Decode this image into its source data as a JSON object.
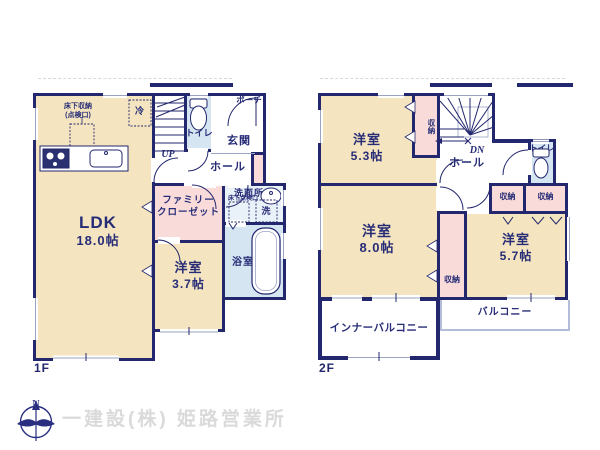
{
  "palette": {
    "wall_navy": "#23276d",
    "room_cream": "#f4e5c0",
    "closet_pink": "#f9dcda",
    "wet_area_blue": "#d5e5f2",
    "footer_gray": "#dadada"
  },
  "floor1": {
    "label": "1F",
    "ldk": {
      "name": "LDK",
      "size": "18.0帖"
    },
    "bedroom": {
      "name": "洋室",
      "size": "3.7帖"
    },
    "family_closet_line1": "ファミリー",
    "family_closet_line2": "クローゼット",
    "bath": "浴室",
    "washroom": "洗面所",
    "washer": "洗",
    "underfloor_hatch": "床下点検口",
    "toilet": "トイレ",
    "entrance": "玄関",
    "hall": "ホール",
    "porch": "ポーチ",
    "stairs_up": "UP",
    "fridge": "冷",
    "underfloor_storage_line1": "床下収納",
    "underfloor_storage_line2": "(点検口)"
  },
  "floor2": {
    "label": "2F",
    "bedroom_53": {
      "name": "洋室",
      "size": "5.3帖"
    },
    "bedroom_80": {
      "name": "洋室",
      "size": "8.0帖"
    },
    "bedroom_57": {
      "name": "洋室",
      "size": "5.7帖"
    },
    "hall": "ホール",
    "stairs_down": "DN",
    "toilet": "トイレ",
    "closet_stairs": "収納",
    "closet_a": "収納",
    "closet_b": "収納",
    "closet_c": "収納",
    "inner_balcony": "インナーバルコニー",
    "balcony": "バルコニー"
  },
  "footer": {
    "compass_n": "N",
    "company": "一建設(株) 姫路営業所"
  }
}
